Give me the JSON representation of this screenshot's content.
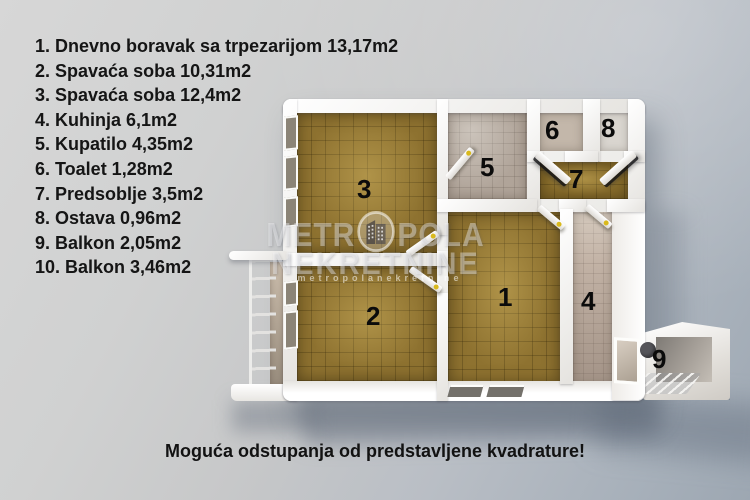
{
  "legend": {
    "items": [
      "1. Dnevno boravak sa trpezarijom 13,17m2",
      "2. Spavaća soba 10,31m2",
      "3. Spavaća soba 12,4m2",
      "4. Kuhinja 6,1m2",
      "5. Kupatilo 4,35m2",
      "6. Toalet 1,28m2",
      "7. Predsoblje 3,5m2",
      "8. Ostava 0,96m2",
      "9. Balkon 2,05m2",
      "10. Balkon 3,46m2"
    ]
  },
  "floorplan": {
    "rooms": {
      "r1": "1",
      "r2": "2",
      "r3": "3",
      "r4": "4",
      "r5": "5",
      "r6": "6",
      "r7": "7",
      "r8": "8",
      "r9": "9"
    }
  },
  "watermark": {
    "brand_line1_left": "METR",
    "brand_line1_right": "POLA",
    "brand_line2": "NEKRETNINE",
    "brand_sub": "metropolanekretnine",
    "logo": "building-icon"
  },
  "caption": {
    "text": "Moguća odstupanja od predstavljene kvadrature!"
  },
  "colors": {
    "parquet_brown": "#8e7230",
    "bath_tile": "#b0a499",
    "kitchen_tile": "#c2b2a5",
    "wall_white": "#f6f5f3",
    "background_grey": "#c7c8c9",
    "shadow_blue_grey": "#9da7b2",
    "text_black": "#141414",
    "door_handle_gold": "#d9b91c"
  }
}
